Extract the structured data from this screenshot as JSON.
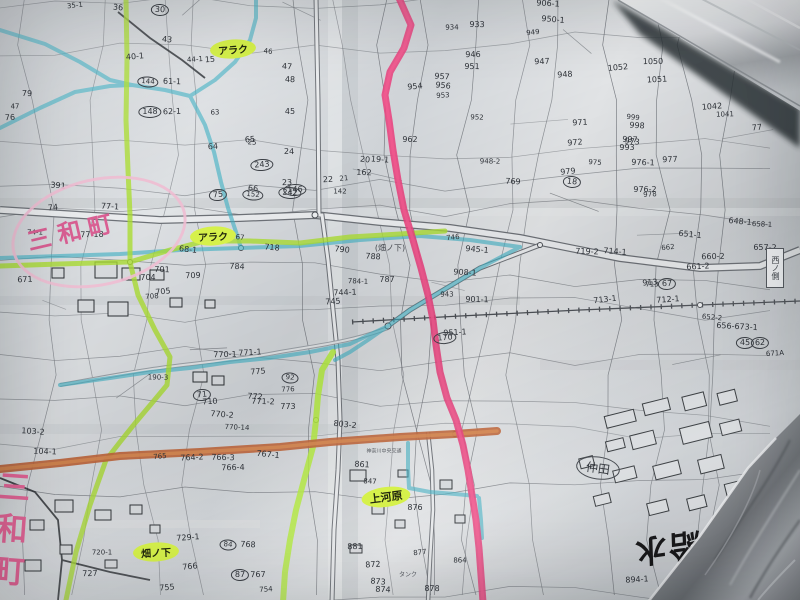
{
  "window": {
    "title": "手書きハイライト入り地籍図の写真"
  },
  "colors": {
    "paper": "#cfd3d6",
    "ink": "#2e3238",
    "pink_line": "#e8417d",
    "pink_core": "#f25a90",
    "green_line": "#aadc32",
    "green_bright": "#b4ec3c",
    "cyan_line": "#3fb0c4",
    "orange_line": "#c0653a",
    "orange_core": "#d98c52",
    "pink_text": "#d95f93"
  },
  "labels": {
    "sanwa_cho_top": "三和町",
    "sanwa_cho_left": "三和町",
    "araku_top": "アラク",
    "araku_mid": "アラク",
    "kamigawara": "上河原",
    "hatanoshita": "畑ノ下",
    "hatanoshita_small": "(畑ノ下)",
    "nakada": "仲田",
    "stamp_right": "西ノ側",
    "bus_note": "神奈川中央交通",
    "tank_note": "タンク",
    "big_note": "高台ノ給水"
  },
  "parcels": [
    [
      "35-1",
      75,
      6,
      0
    ],
    [
      "36",
      118,
      8,
      0
    ],
    [
      "30",
      160,
      10,
      1
    ],
    [
      "79",
      27,
      94,
      0
    ],
    [
      "47",
      15,
      107,
      0
    ],
    [
      "76",
      10,
      118,
      0
    ],
    [
      "40-1",
      135,
      57,
      0
    ],
    [
      "43",
      167,
      40,
      0
    ],
    [
      "144",
      148,
      82,
      1
    ],
    [
      "61-1",
      172,
      82,
      0
    ],
    [
      "148",
      150,
      112,
      1
    ],
    [
      "62-1",
      172,
      112,
      0
    ],
    [
      "44-1",
      195,
      60,
      0
    ],
    [
      "74",
      53,
      208,
      0
    ],
    [
      "391",
      58,
      186,
      0
    ],
    [
      "77-1",
      110,
      207,
      0
    ],
    [
      "74-1",
      35,
      233,
      0
    ],
    [
      "77-18",
      92,
      235,
      0
    ],
    [
      "671",
      25,
      280,
      0
    ],
    [
      "15",
      210,
      60,
      0
    ],
    [
      "46",
      268,
      52,
      0
    ],
    [
      "47",
      287,
      67,
      0
    ],
    [
      "48",
      290,
      80,
      0
    ],
    [
      "45",
      290,
      112,
      0
    ],
    [
      "63",
      215,
      113,
      0
    ],
    [
      "64",
      213,
      147,
      0
    ],
    [
      "65",
      250,
      140,
      0
    ],
    [
      "66",
      253,
      189,
      0
    ],
    [
      "25",
      252,
      143,
      0
    ],
    [
      "24",
      289,
      152,
      0
    ],
    [
      "23",
      287,
      183,
      0
    ],
    [
      "22",
      328,
      180,
      0
    ],
    [
      "21",
      344,
      179,
      0
    ],
    [
      "20",
      365,
      160,
      0
    ],
    [
      "19-1",
      380,
      160,
      0
    ],
    [
      "162",
      364,
      173,
      0
    ],
    [
      "142",
      340,
      192,
      0
    ],
    [
      "146",
      295,
      190,
      1
    ],
    [
      "243",
      262,
      165,
      1
    ],
    [
      "75",
      218,
      195,
      1
    ],
    [
      "152",
      253,
      195,
      1
    ],
    [
      "242",
      290,
      193,
      1
    ],
    [
      "951",
      472,
      67,
      0
    ],
    [
      "946",
      473,
      55,
      0
    ],
    [
      "953",
      443,
      96,
      0
    ],
    [
      "954",
      415,
      87,
      0
    ],
    [
      "956",
      443,
      86,
      0
    ],
    [
      "957",
      442,
      77,
      0
    ],
    [
      "952",
      477,
      118,
      0
    ],
    [
      "962",
      410,
      140,
      0
    ],
    [
      "947",
      542,
      62,
      0
    ],
    [
      "948",
      565,
      75,
      0
    ],
    [
      "949",
      533,
      33,
      0
    ],
    [
      "950-1",
      553,
      20,
      0
    ],
    [
      "906-1",
      548,
      4,
      0
    ],
    [
      "933",
      477,
      25,
      0
    ],
    [
      "934",
      452,
      28,
      0
    ],
    [
      "971",
      580,
      123,
      0
    ],
    [
      "972",
      575,
      143,
      0
    ],
    [
      "973",
      632,
      142,
      0
    ],
    [
      "975",
      595,
      163,
      0
    ],
    [
      "976-1",
      643,
      163,
      0
    ],
    [
      "976-2",
      645,
      190,
      0
    ],
    [
      "977",
      670,
      160,
      0
    ],
    [
      "978",
      650,
      195,
      0
    ],
    [
      "979",
      568,
      172,
      0
    ],
    [
      "18",
      572,
      182,
      1
    ],
    [
      "769",
      513,
      182,
      0
    ],
    [
      "948-2",
      490,
      162,
      0
    ],
    [
      "1050",
      653,
      62,
      0
    ],
    [
      "1051",
      657,
      80,
      0
    ],
    [
      "1052",
      618,
      68,
      0
    ],
    [
      "999",
      633,
      118,
      0
    ],
    [
      "998",
      637,
      126,
      0
    ],
    [
      "997",
      630,
      140,
      0
    ],
    [
      "993",
      627,
      148,
      0
    ],
    [
      "1041",
      725,
      115,
      0
    ],
    [
      "1042",
      712,
      107,
      0
    ],
    [
      "77",
      757,
      128,
      0
    ],
    [
      "648-1",
      740,
      222,
      0
    ],
    [
      "658-1",
      762,
      225,
      0
    ],
    [
      "657-2",
      765,
      248,
      0
    ],
    [
      "660-2",
      713,
      257,
      0
    ],
    [
      "661-2",
      698,
      267,
      0
    ],
    [
      "662",
      668,
      248,
      0
    ],
    [
      "651-1",
      690,
      235,
      0
    ],
    [
      "714-1",
      615,
      252,
      0
    ],
    [
      "719-2",
      587,
      252,
      0
    ],
    [
      "713",
      652,
      285,
      0
    ],
    [
      "67",
      667,
      284,
      1
    ],
    [
      "712-1",
      668,
      300,
      0
    ],
    [
      "713-1",
      605,
      300,
      0
    ],
    [
      "652-2",
      712,
      318,
      0
    ],
    [
      "656-673-1",
      737,
      327,
      0
    ],
    [
      "45",
      745,
      343,
      1
    ],
    [
      "62",
      760,
      343,
      1
    ],
    [
      "671A",
      775,
      354,
      0
    ],
    [
      "913",
      650,
      283,
      0
    ],
    [
      "790",
      342,
      250,
      0
    ],
    [
      "788",
      373,
      257,
      0
    ],
    [
      "784-1",
      358,
      282,
      0
    ],
    [
      "787",
      387,
      280,
      0
    ],
    [
      "744-1",
      345,
      293,
      0
    ],
    [
      "745",
      333,
      302,
      0
    ],
    [
      "746",
      453,
      238,
      0
    ],
    [
      "945-1",
      477,
      250,
      0
    ],
    [
      "908-1",
      465,
      273,
      0
    ],
    [
      "901-1",
      477,
      300,
      0
    ],
    [
      "943",
      447,
      295,
      0
    ],
    [
      "951-1",
      455,
      333,
      0
    ],
    [
      "170",
      445,
      338,
      1
    ],
    [
      "68-1",
      188,
      250,
      0
    ],
    [
      "67",
      240,
      238,
      0
    ],
    [
      "701",
      162,
      270,
      0
    ],
    [
      "704",
      148,
      278,
      0
    ],
    [
      "709",
      193,
      276,
      0
    ],
    [
      "708",
      152,
      297,
      0
    ],
    [
      "705",
      163,
      292,
      0
    ],
    [
      "718",
      272,
      248,
      0
    ],
    [
      "784",
      237,
      267,
      0
    ],
    [
      "190-3",
      158,
      378,
      0
    ],
    [
      "770-1",
      225,
      355,
      0
    ],
    [
      "771-1",
      250,
      353,
      0
    ],
    [
      "775",
      258,
      372,
      0
    ],
    [
      "92",
      290,
      378,
      1
    ],
    [
      "772",
      255,
      397,
      0
    ],
    [
      "771-2",
      263,
      402,
      0
    ],
    [
      "773",
      288,
      407,
      0
    ],
    [
      "776",
      288,
      390,
      0
    ],
    [
      "710",
      210,
      402,
      0
    ],
    [
      "71",
      202,
      395,
      1
    ],
    [
      "770-2",
      222,
      415,
      0
    ],
    [
      "770-14",
      237,
      428,
      0
    ],
    [
      "766-3",
      223,
      458,
      0
    ],
    [
      "766-4",
      233,
      468,
      0
    ],
    [
      "764-2",
      192,
      458,
      0
    ],
    [
      "765",
      160,
      457,
      0
    ],
    [
      "767-1",
      268,
      455,
      0
    ],
    [
      "103-2",
      33,
      432,
      0
    ],
    [
      "104-1",
      45,
      452,
      0
    ],
    [
      "720-1",
      102,
      553,
      0
    ],
    [
      "727",
      90,
      574,
      0
    ],
    [
      "729-1",
      188,
      538,
      0
    ],
    [
      "766",
      190,
      567,
      0
    ],
    [
      "84",
      228,
      545,
      1
    ],
    [
      "768",
      248,
      545,
      0
    ],
    [
      "87",
      240,
      575,
      1
    ],
    [
      "767",
      258,
      575,
      0
    ],
    [
      "754",
      266,
      590,
      0
    ],
    [
      "755",
      167,
      588,
      0
    ],
    [
      "803-2",
      345,
      425,
      0
    ],
    [
      "861",
      362,
      465,
      0
    ],
    [
      "847",
      370,
      482,
      0
    ],
    [
      "876",
      415,
      508,
      0
    ],
    [
      "881",
      355,
      547,
      0
    ],
    [
      "872",
      373,
      565,
      0
    ],
    [
      "877",
      420,
      553,
      0
    ],
    [
      "873",
      378,
      582,
      0
    ],
    [
      "874",
      383,
      590,
      0
    ],
    [
      "878",
      432,
      589,
      0
    ],
    [
      "864",
      460,
      561,
      0
    ],
    [
      "894-1",
      637,
      580,
      0
    ]
  ]
}
